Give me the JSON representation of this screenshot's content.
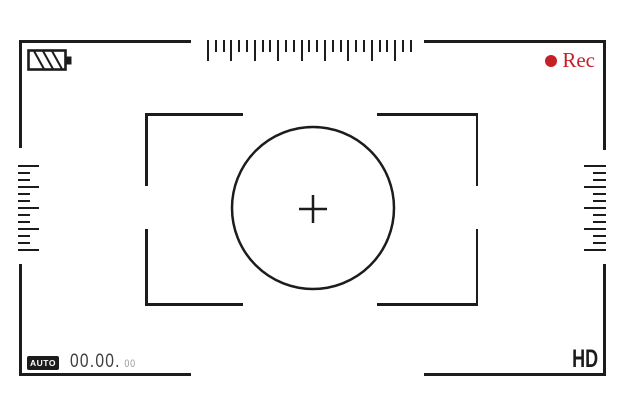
{
  "title": "Camera viewfinder overlay",
  "colors": {
    "background": "#ffffff",
    "line": "#1c1c1c",
    "rec_red": "#c32127",
    "timecode_main": "#3f3f3f",
    "timecode_small": "#9b9b9b"
  },
  "top_bar": {
    "battery_icon": "battery-striped-icon",
    "rec": {
      "dot_icon": "record-dot-icon",
      "label": "Rec"
    }
  },
  "rulers": {
    "top": {
      "orientation": "horizontal",
      "count": 27,
      "period": 3,
      "long_px": 21,
      "short_px": 12,
      "spacing_px": 7.8,
      "thickness_px": 2
    },
    "left": {
      "orientation": "vertical",
      "align": "left",
      "count": 13,
      "period": 3,
      "long_px": 21,
      "short_px": 12,
      "spacing_px": 7,
      "thickness_px": 2
    },
    "right": {
      "orientation": "vertical",
      "align": "right",
      "count": 13,
      "period": 3,
      "long_px": 22,
      "short_px": 13,
      "spacing_px": 7,
      "thickness_px": 2
    }
  },
  "focus": {
    "crosshair_icon": "crosshair-plus-icon",
    "circle_icon": "focus-circle"
  },
  "bottom_bar": {
    "mode_label": "AUTO",
    "timecode": {
      "full": "00.00.00",
      "main": "00.00.",
      "frames": "00"
    },
    "quality_label": "HD"
  }
}
